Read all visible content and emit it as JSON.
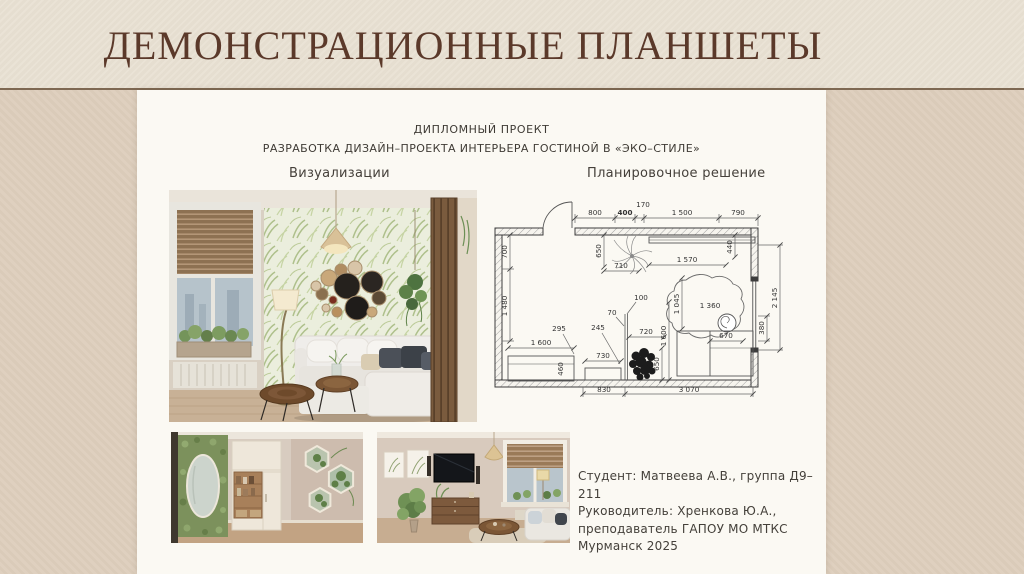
{
  "slide": {
    "title": "ДЕМОНСТРАЦИОННЫЕ ПЛАНШЕТЫ"
  },
  "poster": {
    "header_line1": "ДИПЛОМНЫЙ ПРОЕКТ",
    "header_line2": "РАЗРАБОТКА ДИЗАЙН–ПРОЕКТА ИНТЕРЬЕРА ГОСТИНОЙ В «ЭКО–СТИЛЕ»",
    "section_left": "Визуализации",
    "section_right": "Планировочное решение",
    "credits": {
      "line1": "Студент: Матвеева А.В., группа Д9–211",
      "line2": "Руководитель: Хренкова Ю.А.,",
      "line3": "преподаватель ГАПОУ МО МТКС",
      "line4": "Мурманск 2025"
    }
  },
  "plan": {
    "top": [
      "800",
      "400",
      "170",
      "1 500",
      "790"
    ],
    "left": [
      "700",
      "1 480"
    ],
    "right": [
      "380",
      "2 145"
    ],
    "bottom": [
      "830",
      "3 070"
    ],
    "inner": [
      "650",
      "710",
      "1 570",
      "440",
      "1 045",
      "1 360",
      "670",
      "100",
      "70",
      "295",
      "245",
      "720",
      "1 600",
      "650",
      "1 600",
      "460",
      "730"
    ]
  },
  "colors": {
    "title_text": "#5b392a",
    "band_bg": "#e9e1d3",
    "slide_bg": "#ddcebc",
    "poster_bg": "#fbf9f3"
  }
}
